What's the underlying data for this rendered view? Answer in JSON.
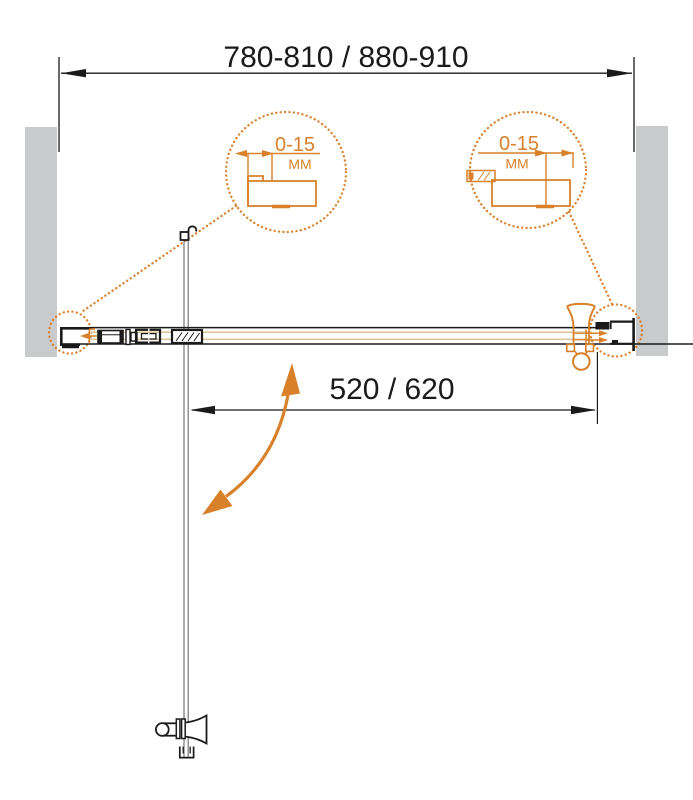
{
  "diagram": {
    "overall_width_label": "780-810 / 880-910",
    "door_width_label": "520 / 620",
    "detail_left": {
      "range": "0-15",
      "unit": "MM"
    },
    "detail_right": {
      "range": "0-15",
      "unit": "MM"
    },
    "colors": {
      "accent": "#D8812A",
      "wall": "#C9CACB",
      "ink": "#1A1A1A",
      "rail": "#DCC49C",
      "door": "#777777",
      "background": "#FFFFFF"
    }
  }
}
